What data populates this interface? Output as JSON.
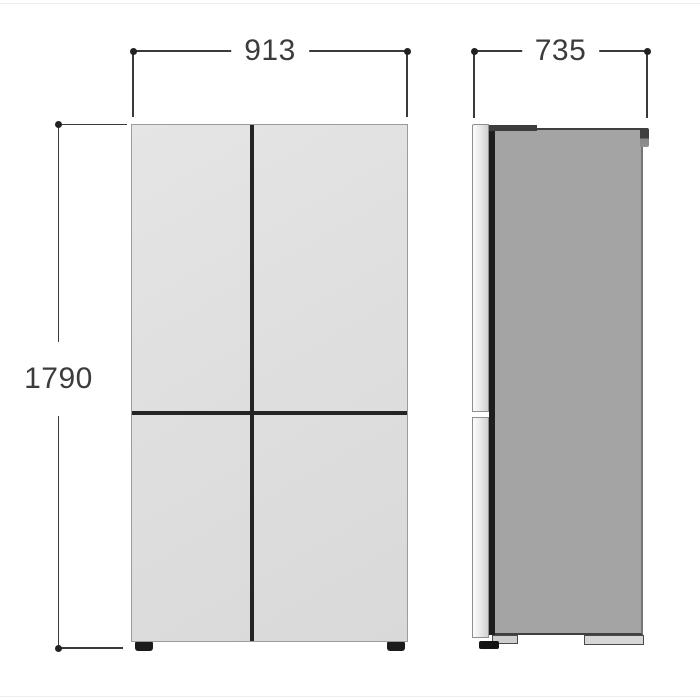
{
  "diagram": {
    "kind": "appliance-dimension-drawing",
    "views": {
      "front": "front-view",
      "side": "side-view"
    },
    "dimensions": {
      "width": {
        "value": "913"
      },
      "depth": {
        "value": "735"
      },
      "height": {
        "value": "1790"
      }
    },
    "colors": {
      "dimension_line": "#3a3a3a",
      "dimension_text": "#3c3c3c",
      "front_panel": "#dfdfdf",
      "door_split": "#242424",
      "side_body": "#a4a4a4",
      "side_door_edge": "#ececec",
      "door_gap": "#1e1e1e",
      "foot": "#1b1b1b",
      "background": "#ffffff"
    }
  }
}
